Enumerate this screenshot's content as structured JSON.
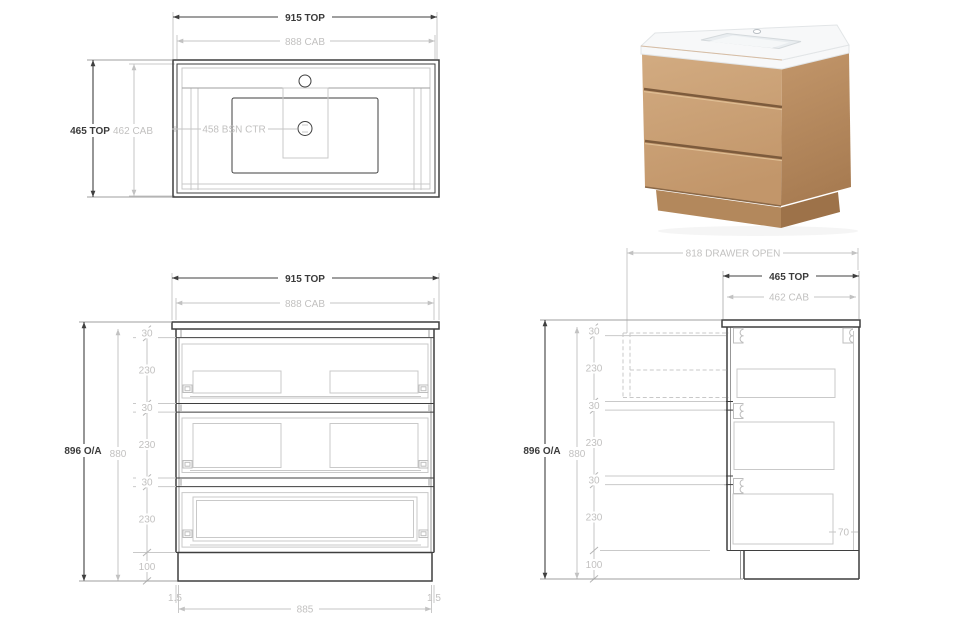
{
  "page": {
    "background": "#ffffff"
  },
  "colors": {
    "ink": "#3d3d3d",
    "dim_line": "#c9c9c9",
    "dim_text": "#c2c1c0"
  },
  "plan_view": {
    "dim_width_top": "915 TOP",
    "dim_width_cab": "888 CAB",
    "dim_depth_top": "465 TOP",
    "dim_depth_cab": "462 CAB",
    "dim_basin_centre": "458 BSN CTR"
  },
  "front_view": {
    "dim_width_top": "915 TOP",
    "dim_width_cab": "888 CAB",
    "dim_overall_height": "896 O/A",
    "dim_cab_height": "880",
    "segments": [
      "30",
      "230",
      "30",
      "230",
      "30",
      "230",
      "100"
    ],
    "dim_side_gap_left": "1.5",
    "dim_internal_width": "885",
    "dim_side_gap_right": "1.5"
  },
  "side_view": {
    "dim_drawer_open": "818 DRAWER OPEN",
    "dim_depth_top": "465 TOP",
    "dim_depth_cab": "462 CAB",
    "dim_overall_height": "896 O/A",
    "dim_cab_height": "880",
    "segments": [
      "30",
      "230",
      "30",
      "230",
      "30",
      "230",
      "100"
    ],
    "dim_drawer_back_gap": "70"
  },
  "product_render": {
    "colors": {
      "top_white": "#f7f8f9",
      "top_edge": "#eef0f2",
      "basin_shade": "#e9edf0",
      "basin_inner": "#f5f7f8",
      "wood_front_light": "#d2ab81",
      "wood_front_dark": "#c2966a",
      "wood_side_light": "#c2966a",
      "wood_side_dark": "#a87c52",
      "gap_dark": "#7d5b3c",
      "gap_highlight": "#e0c096",
      "kick_front": "#b3885c",
      "kick_side": "#9d7249",
      "under_top_shadow": "#8a6847"
    }
  }
}
